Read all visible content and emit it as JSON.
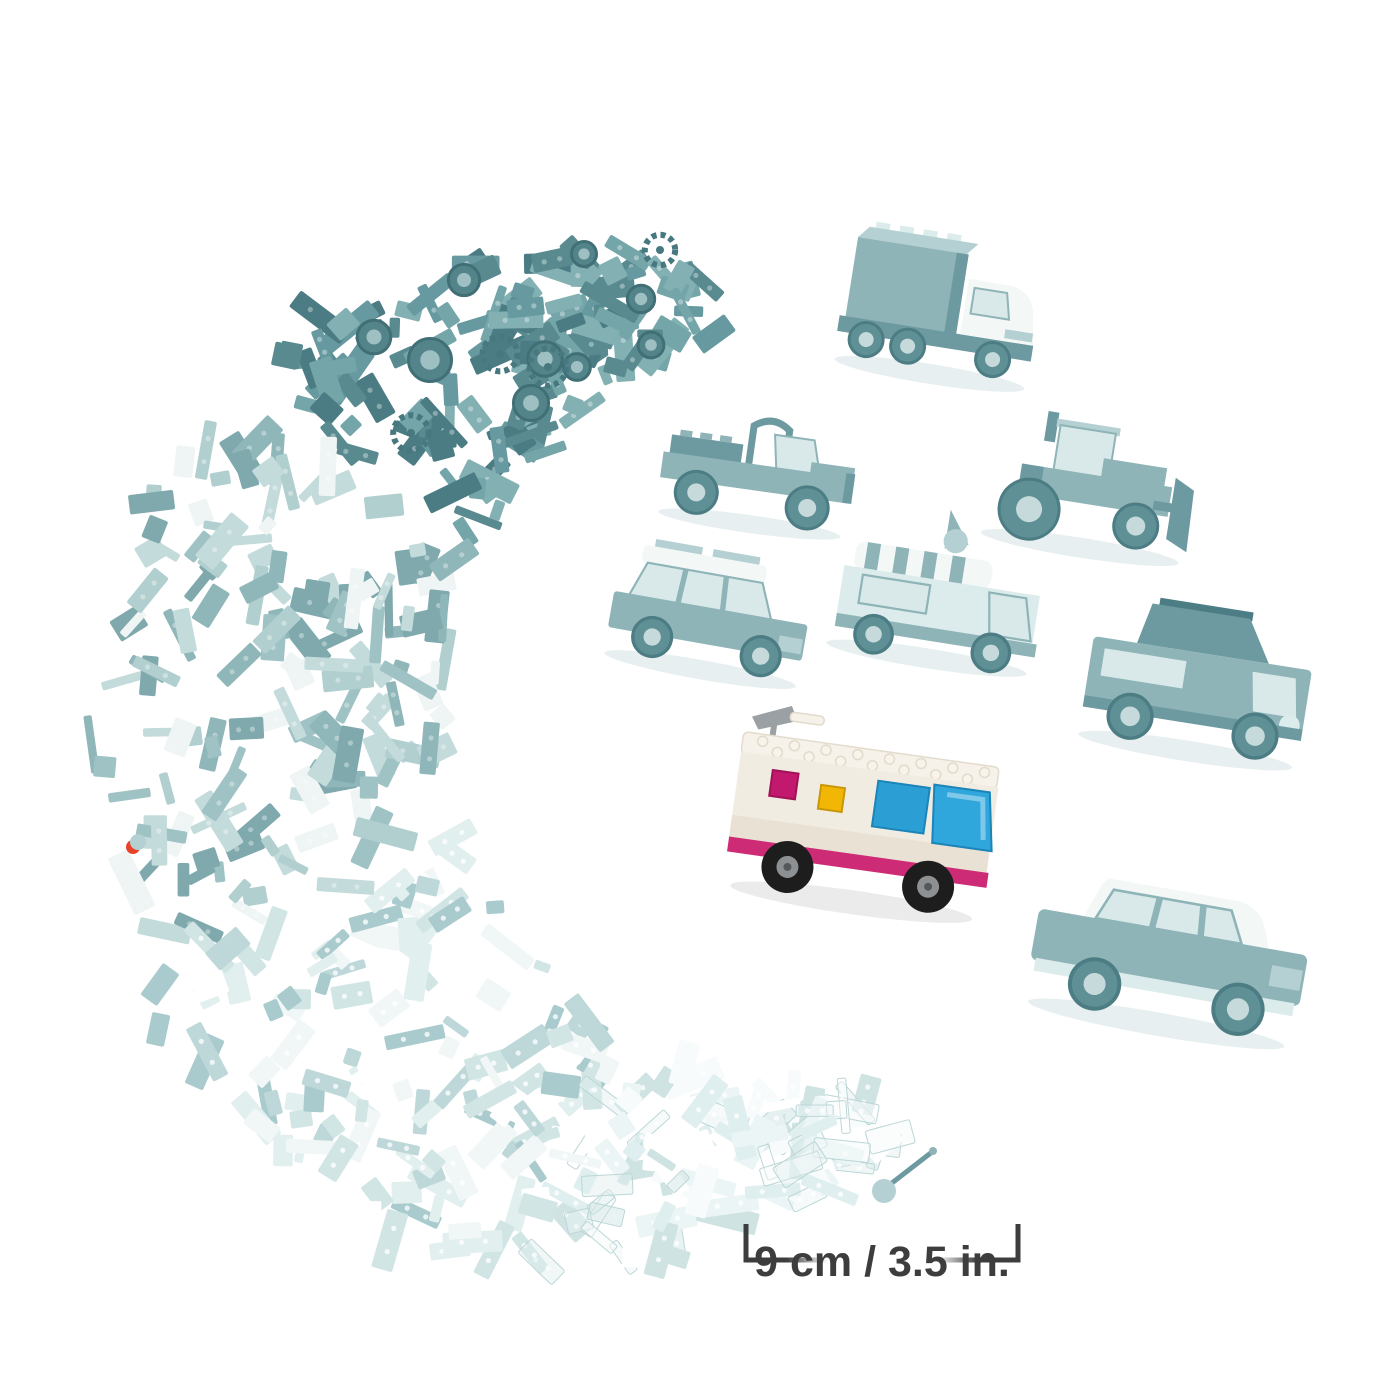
{
  "image": {
    "kind": "toy-bricks-product-photo",
    "background": "#ffffff"
  },
  "measurement": {
    "label": "9 cm / 3.5 in.",
    "color": "#3d3d3d"
  },
  "builds": [
    {
      "id": "cargo-truck",
      "tinted": true
    },
    {
      "id": "off-road-buggy",
      "tinted": true
    },
    {
      "id": "tractor",
      "tinted": true
    },
    {
      "id": "roof-rack-car",
      "tinted": true
    },
    {
      "id": "ice-cream-van",
      "tinted": true
    },
    {
      "id": "pop-top-camper",
      "tinted": true
    },
    {
      "id": "color-motorhome",
      "tinted": false
    },
    {
      "id": "classic-car",
      "tinted": true
    }
  ],
  "highlight_build": {
    "name": "color-motorhome",
    "roof": "#f6f2ea",
    "body": "#f1ece2",
    "body_shade": "#e9e2d4",
    "trim_magenta": "#ce2b76",
    "windshield_blue": "#2fa6dc",
    "window_blue": "#2b9fd4",
    "window_magenta": "#c2186e",
    "window_yellow": "#f2b705",
    "wheel": "#1d1d1d",
    "hub": "#8d9093",
    "spoiler_gray": "#9aa0a4"
  },
  "tint_palette": {
    "dark": "#588a90",
    "mid": "#8fb6b9",
    "light": "#bed8d9",
    "pale": "#e4f0f0",
    "white": "#f3f8f7"
  },
  "loose_pieces": {
    "red_piece_color": "#e8432a"
  },
  "pile": {
    "seed": 20240511,
    "brick_count": 520,
    "center": {
      "x": 760,
      "y": 720
    },
    "angle_start": 73,
    "angle_end": 262,
    "radius": 430,
    "band_extra": 230,
    "zone_breaks": [
      210,
      158,
      112
    ],
    "zones": {
      "dark": [
        "#4c7c83",
        "#588a90",
        "#679aa0",
        "#74a5a9",
        "#82b0b3"
      ],
      "mid": [
        "#7fa9ad",
        "#8fb6b9",
        "#9fc2c4",
        "#b2cfd0",
        "#c4dbdb",
        "#eef5f4"
      ],
      "light": [
        "#aacbcd",
        "#bed8d9",
        "#d2e5e5",
        "#e2efef",
        "#f1f7f7",
        "#ffffff"
      ],
      "pale": [
        "#cfe3e3",
        "#dfeeee",
        "#ecf5f5",
        "#f7fbfb",
        "#ffffff"
      ]
    },
    "tires": {
      "count": 9,
      "angle_start": 220,
      "angle_end": 258,
      "fill": "#538489",
      "stroke": "#416f76",
      "hub": "#9fc0c3"
    },
    "gears": {
      "count": 4,
      "color": "#47787f"
    }
  }
}
